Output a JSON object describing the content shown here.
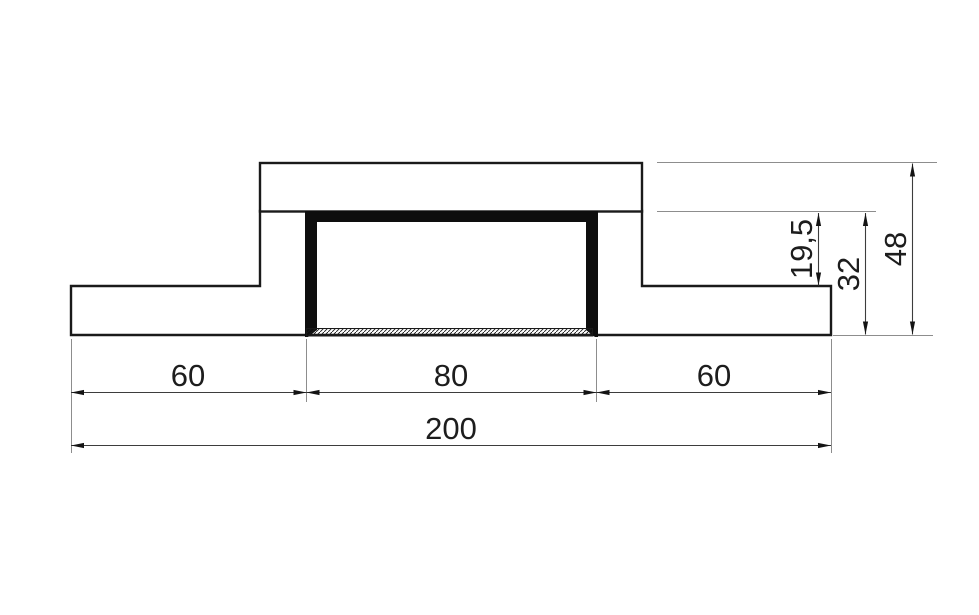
{
  "figure": {
    "type": "technical-cross-section-drawing",
    "dims": {
      "width_left": "60",
      "width_center": "80",
      "width_right": "60",
      "width_total": "200",
      "height_inner": "19,5",
      "height_step": "32",
      "height_total": "48"
    },
    "colors": {
      "background": "#ffffff",
      "outline": "#1a1a1a",
      "channel_fill": "#0e0e0e",
      "dimension_line": "#3d3d3d",
      "extension_line": "#8d8d8d",
      "text": "#1d1d1d"
    }
  }
}
